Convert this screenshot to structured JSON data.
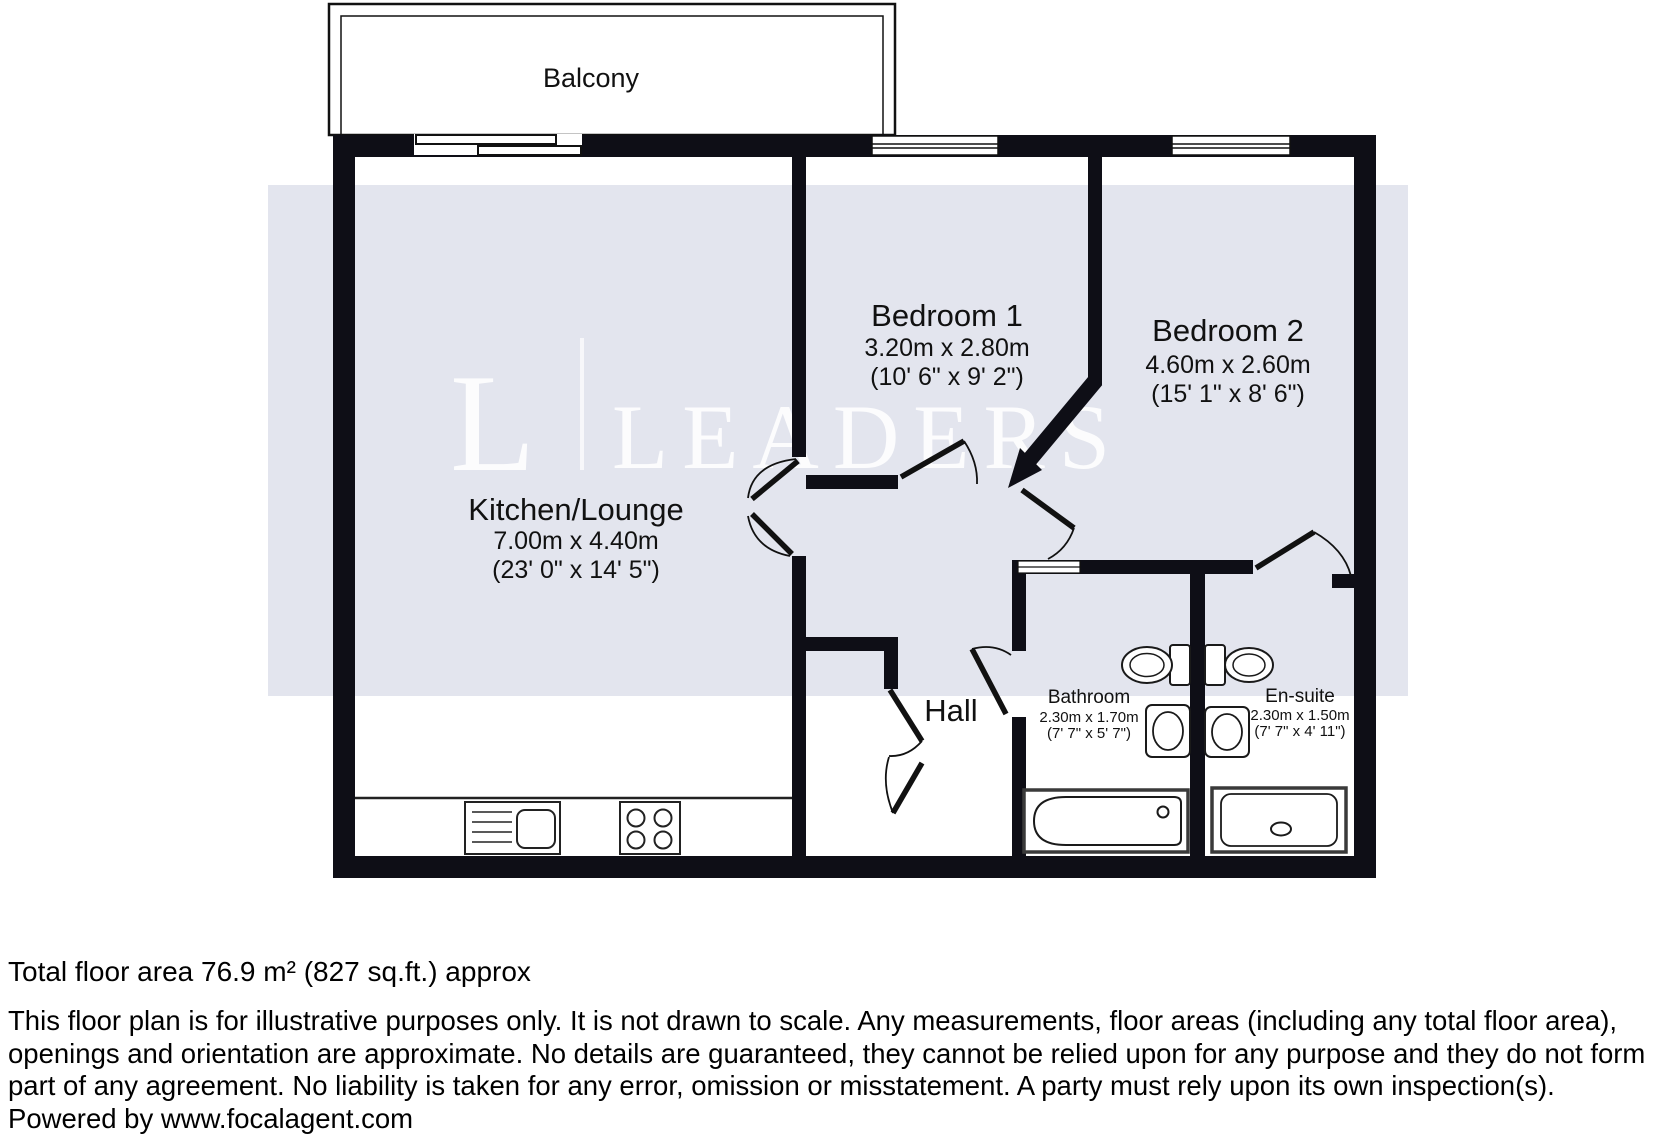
{
  "floorplan": {
    "balcony": {
      "label": "Balcony"
    },
    "rooms": {
      "kitchen_lounge": {
        "name": "Kitchen/Lounge",
        "metric": "7.00m x 4.40m",
        "imperial": "(23' 0\" x 14' 5\")"
      },
      "bedroom1": {
        "name": "Bedroom 1",
        "metric": "3.20m x 2.80m",
        "imperial": "(10' 6\" x 9' 2\")"
      },
      "bedroom2": {
        "name": "Bedroom 2",
        "metric": "4.60m x 2.60m",
        "imperial": "(15' 1\" x 8' 6\")"
      },
      "hall": {
        "name": "Hall"
      },
      "bathroom": {
        "name": "Bathroom",
        "metric": "2.30m x 1.70m",
        "imperial": "(7' 7\" x 5' 7\")"
      },
      "ensuite": {
        "name": "En-suite",
        "metric": "2.30m x 1.50m",
        "imperial": "(7' 7\" x 4' 11\")"
      }
    },
    "watermark": {
      "initial": "L",
      "word": "LEADERS"
    },
    "colors": {
      "wall": "#0e0e16",
      "band": "#e3e5ee",
      "watermark": "#ffffff"
    }
  },
  "footer": {
    "total_area": "Total floor area 76.9 m² (827 sq.ft.) approx",
    "disclaimer": "This floor plan is for illustrative purposes only. It is not drawn to scale. Any measurements, floor areas (including any total floor area), openings and orientation are approximate. No details are guaranteed, they cannot be relied upon for any purpose and they do not form part of any agreement. No liability is taken for any error, omission or misstatement. A party must rely upon its own inspection(s).",
    "powered_by": "Powered by www.focalagent.com"
  }
}
